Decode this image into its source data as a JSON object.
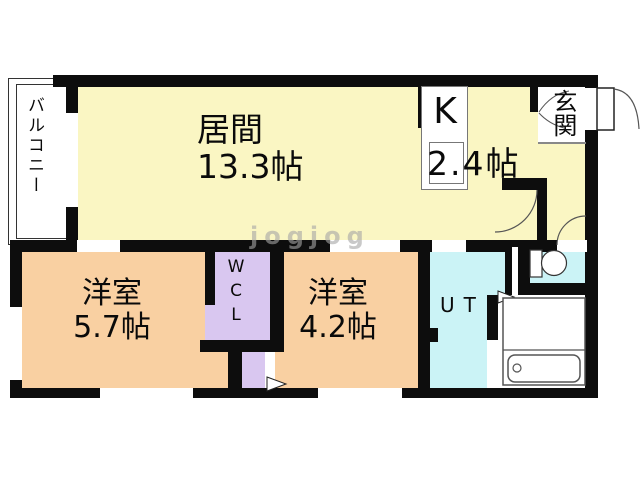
{
  "plan": {
    "watermark": "jogjog",
    "balcony": {
      "label": "バルコニー"
    },
    "living": {
      "label": "居間",
      "size": "13.3帖"
    },
    "kitchen": {
      "label": "K",
      "size": "2.4帖"
    },
    "entrance": {
      "label": "玄関"
    },
    "bedroom_a": {
      "label": "洋室",
      "size": "5.7帖"
    },
    "closet": {
      "label": "WCL"
    },
    "bedroom_b": {
      "label": "洋室",
      "size": "4.2帖"
    },
    "utility": {
      "label": "UT"
    },
    "colors": {
      "living_yellow": "#FAF6C3",
      "bedroom_orange": "#F9D0A2",
      "closet_purple": "#D9C7F0",
      "wet_area_cyan": "#CBF3F6",
      "wall_black": "#0d0d0d"
    }
  }
}
